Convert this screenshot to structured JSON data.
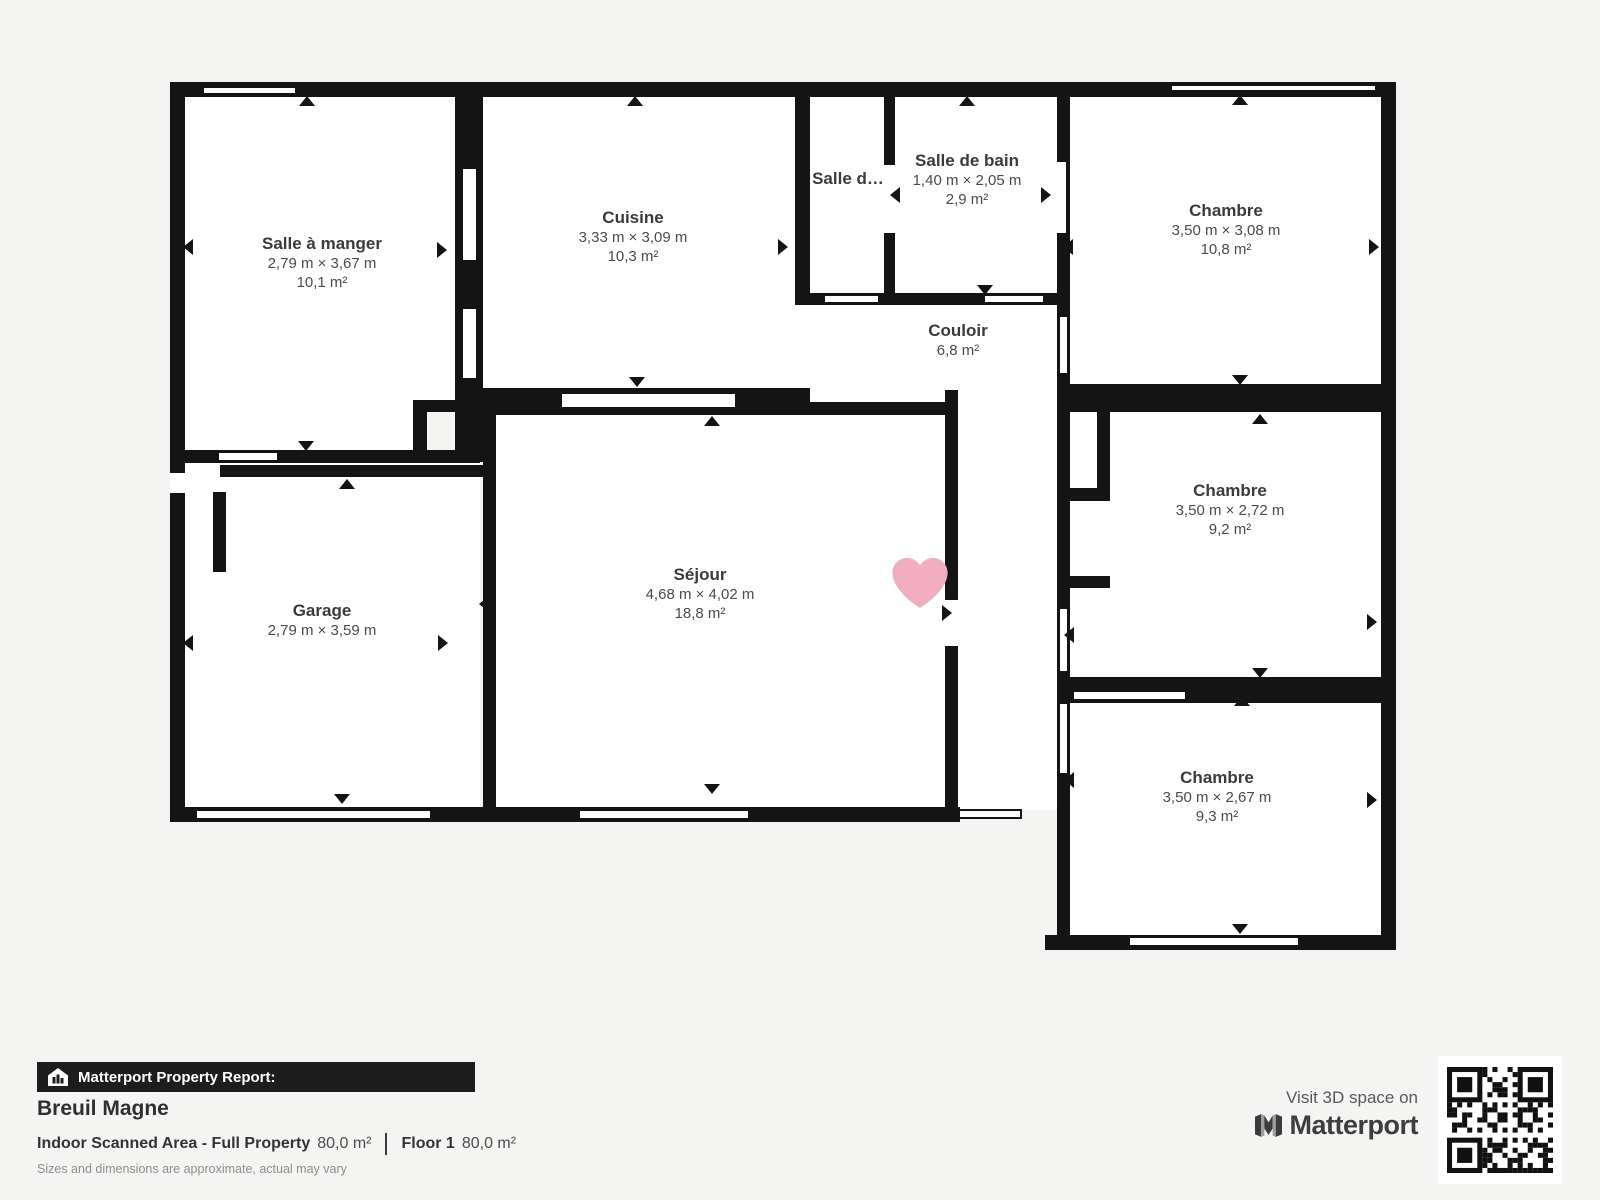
{
  "page": {
    "background": "#f4f4f3"
  },
  "plan": {
    "wall_color": "#141414",
    "room_fill": "#ffffff",
    "heart_color": "#F2ACBF",
    "rooms": [
      {
        "name": "Salle à manger",
        "dims": "2,79 m × 3,67 m",
        "area": "10,1 m²",
        "cx": 322,
        "cy": 244
      },
      {
        "name": "Cuisine",
        "dims": "3,33 m × 3,09 m",
        "area": "10,3 m²",
        "cx": 633,
        "cy": 218
      },
      {
        "name": "Salle d…",
        "dims": "",
        "area": "",
        "cx": 848,
        "cy": 179
      },
      {
        "name": "Salle de bain",
        "dims": "1,40 m × 2,05 m",
        "area": "2,9 m²",
        "cx": 967,
        "cy": 161
      },
      {
        "name": "Chambre",
        "dims": "3,50 m × 3,08 m",
        "area": "10,8 m²",
        "cx": 1226,
        "cy": 211
      },
      {
        "name": "Couloir",
        "dims": "",
        "area": "6,8 m²",
        "cx": 958,
        "cy": 331
      },
      {
        "name": "Chambre",
        "dims": "3,50 m × 2,72 m",
        "area": "9,2 m²",
        "cx": 1230,
        "cy": 491
      },
      {
        "name": "Chambre",
        "dims": "3,50 m × 2,67 m",
        "area": "9,3 m²",
        "cx": 1217,
        "cy": 778
      },
      {
        "name": "Garage",
        "dims": "2,79 m × 3,59 m",
        "area": "",
        "cx": 322,
        "cy": 611
      },
      {
        "name": "Séjour",
        "dims": "4,68 m × 4,02 m",
        "area": "18,8 m²",
        "cx": 700,
        "cy": 575
      }
    ]
  },
  "report": {
    "banner_label": "Matterport Property Report:",
    "property_name": "Breuil Magne",
    "area_label": "Indoor Scanned Area - Full Property",
    "area_value": "80,0 m²",
    "floor_label": "Floor 1",
    "floor_value": "80,0 m²",
    "disclaimer": "Sizes and dimensions are approximate, actual may vary"
  },
  "cta": {
    "visit_text": "Visit 3D space on",
    "brand": "Matterport"
  },
  "icons": {
    "banner_icon": "house-chart-icon",
    "brand_icon": "matterport-logo-icon",
    "qr_icon": "qr-code",
    "heart_icon": "heart-icon",
    "door_icon": "door-arrow-icon"
  }
}
